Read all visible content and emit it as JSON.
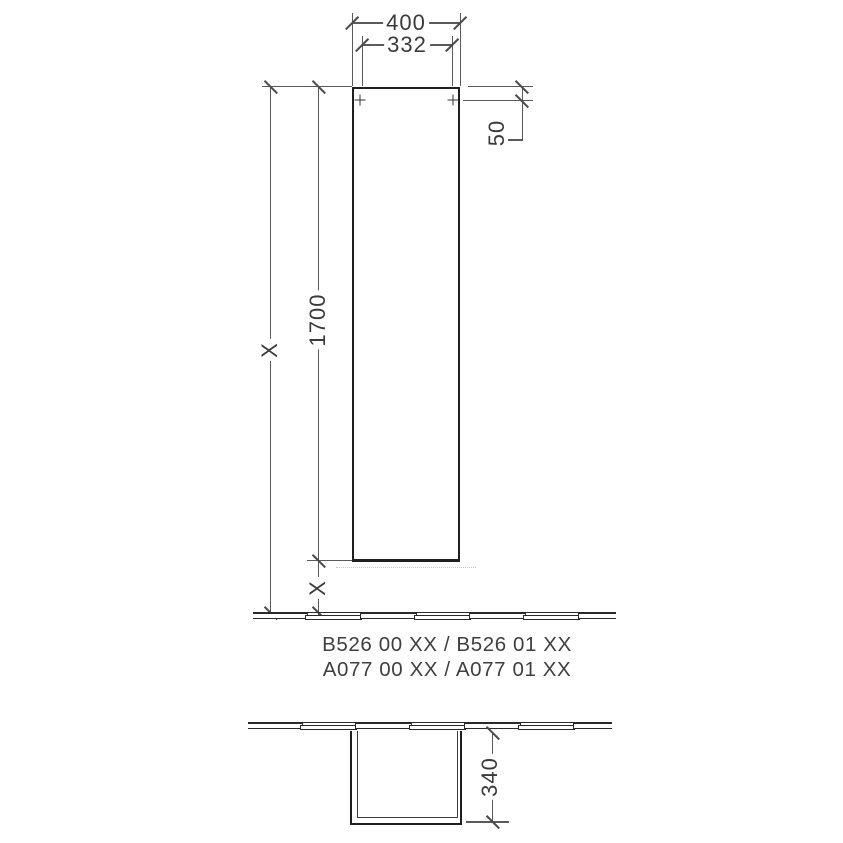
{
  "drawing": {
    "front_view": {
      "width_outer": "400",
      "width_inner": "332",
      "fixing_offset": "50",
      "cabinet_height": "1700",
      "total_height_label": "X",
      "floor_gap_label": "X"
    },
    "product_codes": {
      "line1": "B526 00 XX / B526 01 XX",
      "line2": "A077 00 XX / A077 01 XX"
    },
    "plan_view": {
      "depth": "340"
    },
    "colors": {
      "object_line": "#1f1f1f",
      "dimension_line": "#5a5a5a",
      "text": "#3a3a3a",
      "background": "#ffffff"
    }
  }
}
